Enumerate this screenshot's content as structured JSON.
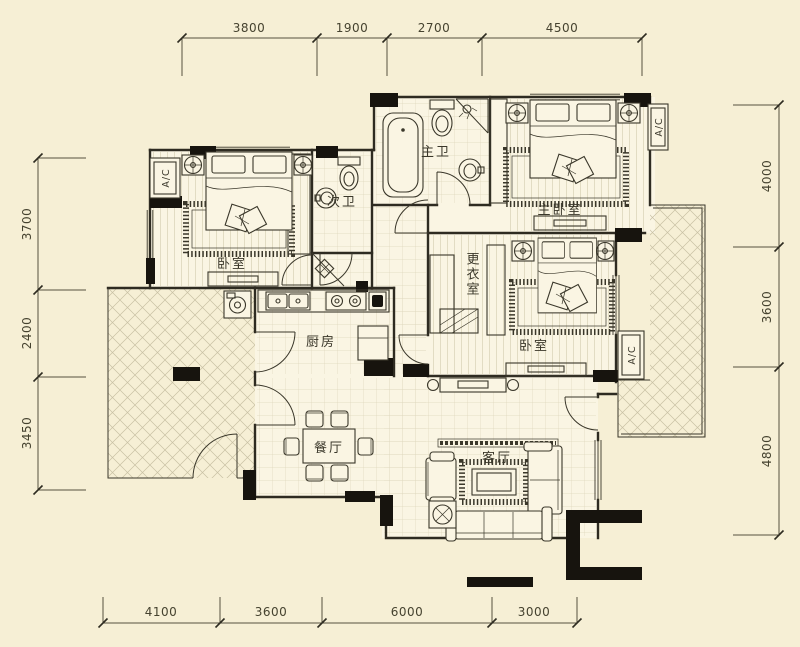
{
  "plan": {
    "type": "apartment-floor-plan",
    "rooms": {
      "bedroom1": "卧室",
      "bath2": "次卫",
      "master_bath": "主卫",
      "master_bedroom": "主卧室",
      "dressing": "更衣室",
      "bedroom2": "卧室",
      "kitchen": "厨房",
      "dining": "餐厅",
      "living": "客厅"
    },
    "ac_label": "A/C",
    "dimensions": {
      "top": [
        "3800",
        "1900",
        "2700",
        "4500"
      ],
      "left": [
        "3700",
        "2400",
        "3450"
      ],
      "right": [
        "4000",
        "3600",
        "4800"
      ],
      "bottom": [
        "4100",
        "3600",
        "6000",
        "3000"
      ]
    },
    "colors": {
      "background": "#f6efd5",
      "floor": "#faf5e3",
      "wall": "#2e2b21",
      "grid": "#ddd6bb",
      "hatch": "#c8c0a3",
      "text": "#3a372a"
    }
  }
}
